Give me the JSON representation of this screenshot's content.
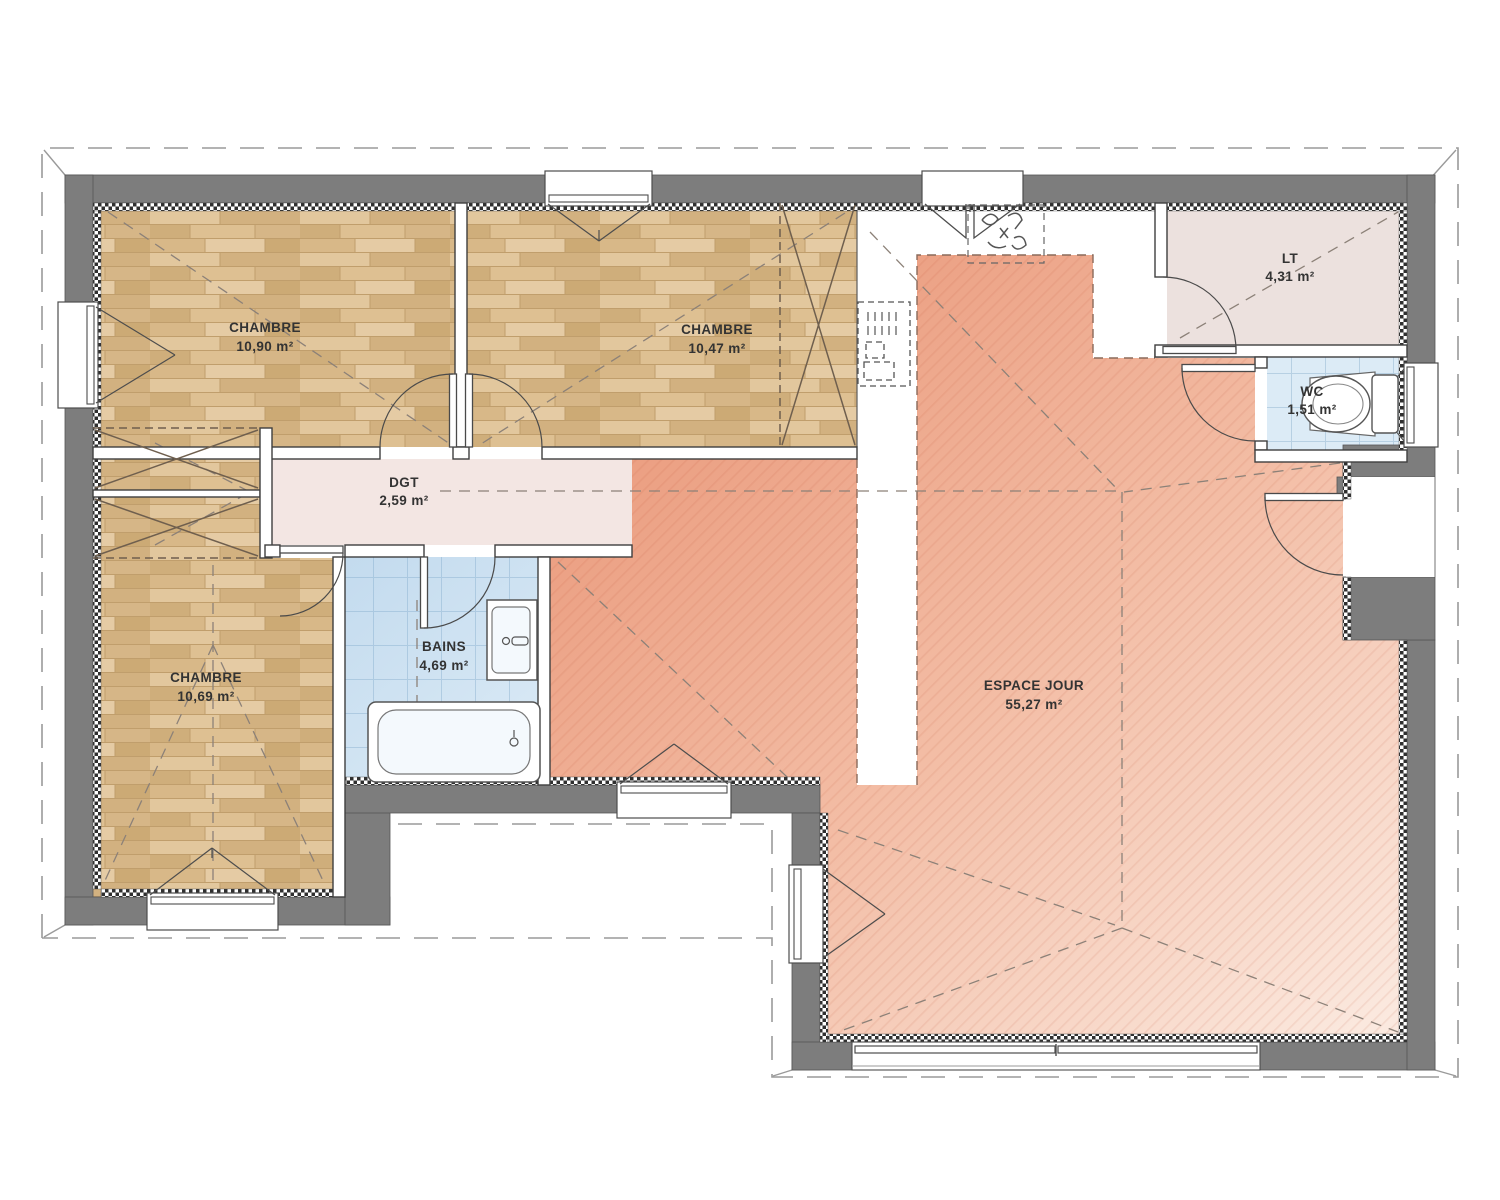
{
  "plan": {
    "rooms": {
      "chambre1": {
        "label": "CHAMBRE",
        "area": "10,90 m²"
      },
      "chambre2": {
        "label": "CHAMBRE",
        "area": "10,47 m²"
      },
      "chambre3": {
        "label": "CHAMBRE",
        "area": "10,69 m²"
      },
      "degagement": {
        "label": "DGT",
        "area": "2,59 m²"
      },
      "bains": {
        "label": "BAINS",
        "area": "4,69 m²"
      },
      "cellier": {
        "label": "LT",
        "area": "4,31 m²"
      },
      "wc": {
        "label": "WC",
        "area": "1,51 m²"
      },
      "espace_jour": {
        "label": "ESPACE JOUR",
        "area": "55,27 m²"
      }
    },
    "colors": {
      "wall": "#7d7d7d",
      "wood_floor": "#d9ba8c",
      "tile_floor": "#dcebf6",
      "living_floor_dark": "#ea9a7c",
      "living_floor_mid": "#f3bda5",
      "living_floor_light": "#fbe9df",
      "hall_floor": "#f3e6e3",
      "storage_floor": "#ece1de",
      "label_text": "#333333"
    }
  }
}
